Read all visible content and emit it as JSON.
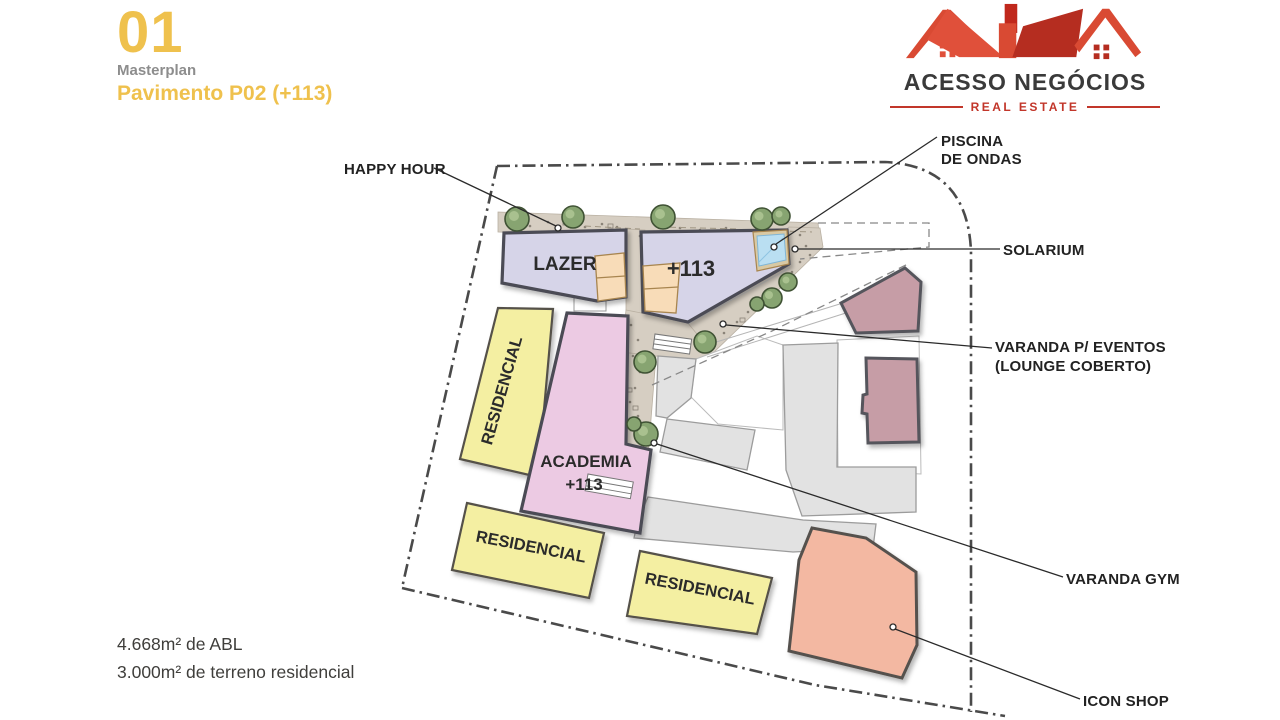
{
  "header": {
    "number": "01",
    "subtitle": "Masterplan",
    "title": "Pavimento P02 (+113)"
  },
  "logo": {
    "brand": "ACESSO NEGÓCIOS",
    "tagline": "REAL ESTATE"
  },
  "stats": {
    "abl": "4.668m² de ABL",
    "terreno": "3.000m² de terreno residencial"
  },
  "plan": {
    "labels": {
      "lazer": "LAZER",
      "plus113": "+113",
      "residencial1": "RESIDENCIAL",
      "academia_line1": "ACADEMIA",
      "academia_line2": "+113",
      "residencial2": "RESIDENCIAL",
      "residencial3": "RESIDENCIAL"
    },
    "callouts": {
      "happy_hour": "HAPPY HOUR",
      "piscina_line1": "PISCINA",
      "piscina_line2": "DE ONDAS",
      "solarium": "SOLARIUM",
      "varanda_eventos_line1": "VARANDA P/ EVENTOS",
      "varanda_eventos_line2": "(LOUNGE COBERTO)",
      "varanda_gym": "VARANDA GYM",
      "icon_shop": "ICON SHOP"
    }
  },
  "colors": {
    "accent_gold": "#EFC14D",
    "logo_red": "#D94A33",
    "logo_dark_red": "#B52D20",
    "building_lavender": "#D6D4E8",
    "building_yellow": "#F4EFA2",
    "building_pink": "#ECCAE3",
    "building_peach": "#F8DCB8",
    "building_mauve": "#C69DA6",
    "building_salmon": "#F3B8A2",
    "pool_blue": "#BADFF2",
    "path_tan": "#D6CEC2",
    "tree_green": "#87A471"
  }
}
